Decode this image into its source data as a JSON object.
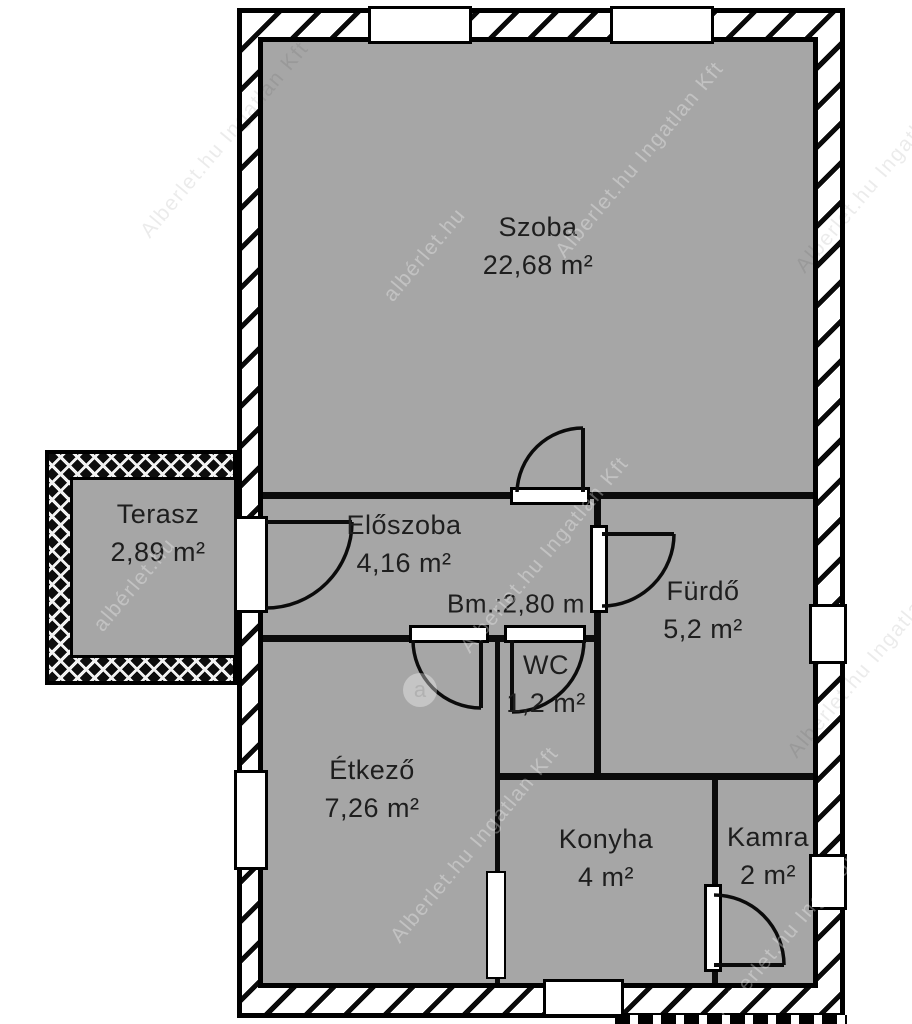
{
  "plan": {
    "rooms": [
      {
        "name": "Szoba",
        "area": "22,68 m²"
      },
      {
        "name": "Terasz",
        "area": "2,89 m²"
      },
      {
        "name": "Előszoba",
        "area": "4,16 m²"
      },
      {
        "name": "Fürdő",
        "area": "5,2 m²"
      },
      {
        "name": "WC",
        "area": "1,2 m²"
      },
      {
        "name": "Étkező",
        "area": "7,26 m²"
      },
      {
        "name": "Konyha",
        "area": "4 m²"
      },
      {
        "name": "Kamra",
        "area": "2 m²"
      }
    ],
    "ceiling_height_label": "Bm.:2,80 m",
    "colors": {
      "floor_gray": "#a6a6a6",
      "wall_line": "#000000",
      "background": "#ffffff"
    },
    "watermarks": {
      "company": "Alberlet.hu Ingatlan Kft",
      "site": "albérlet.hu",
      "badge": "a"
    }
  }
}
